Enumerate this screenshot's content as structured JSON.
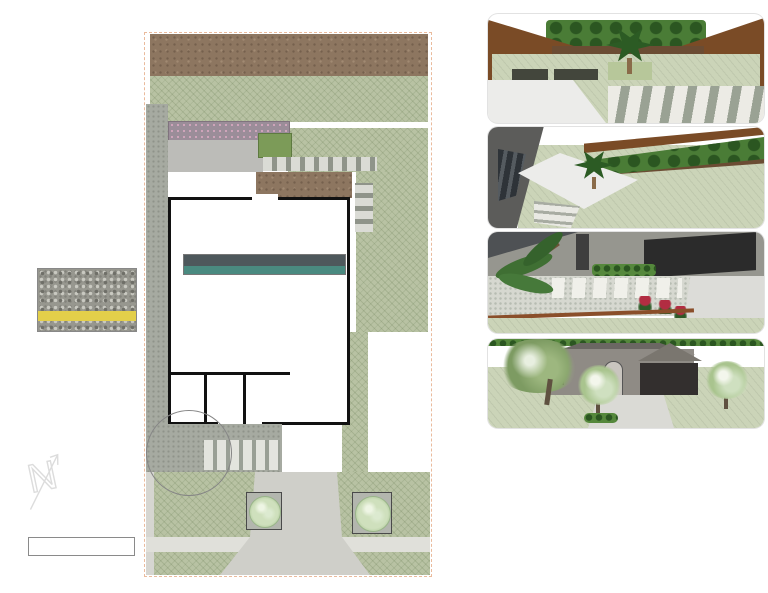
{
  "callouts": [
    {
      "id": "cherry-laurel",
      "text": "Cherry Laurel"
    },
    {
      "id": "tx-mountain-laurel",
      "text": "Tx Mountain Laurel"
    },
    {
      "id": "sago-palm",
      "text": "Sago Palm"
    },
    {
      "id": "saw-palmetto",
      "text": "Saw Palmetto"
    },
    {
      "id": "silvermist-top",
      "text": "5/8\" SILVERMIST\nGRAVEL W. BLACK\nSTEEL EDGING"
    },
    {
      "id": "brakelights-red-yucca",
      "text": "Brakelights Red Yucca"
    },
    {
      "id": "may-night-sage",
      "text": "May Night Sage"
    },
    {
      "id": "pindo-palm",
      "text": "Pindo Palm"
    },
    {
      "id": "autumn-sage-red",
      "text": "Autumn Sage Red"
    },
    {
      "id": "bamboo-muhly",
      "text": "Bamboo Muhly"
    },
    {
      "id": "clumping-bamboo",
      "text": "Clumping Bamboo, Graceful"
    },
    {
      "id": "silvermist-bottom",
      "text": "5/8\" SILVERMIST\nGRAVEL W. BLACK\nSTEEL EDGING"
    },
    {
      "id": "mexican-feathergrass",
      "text": "Mexican Feathergrass"
    },
    {
      "id": "yucca-rostrata",
      "text": "Yucca Rostrata"
    },
    {
      "id": "whales-tongue-agave",
      "text": "Whales Tongue Agave"
    },
    {
      "id": "silver-ponyfoot",
      "text": "Silver Ponyfoot"
    },
    {
      "id": "palo-verde-tree",
      "text": "Palo Verde Tree"
    },
    {
      "id": "crape-myrtle-natchez",
      "text": "Crape Myrtle,\nNatchez"
    }
  ],
  "notes": {
    "steel_edging": "-66 LINEAR FEET\nSTEEL EDGING\n-800 SQ FT MULCH\nAND NEW SOIL",
    "blackstar": "920 SQ FT\n5/8\" BLACKSTAR\nGRAVEL",
    "pavers": "140 SQ FT CUSTOM\nPOURED CONCRETE\nPAVERS, BROOM FINISH",
    "edging_bottom": "110 LINEAR FEET STEEL EDGING"
  },
  "dimensions": {
    "backyard_bed_depth": "12'-6\"",
    "front_gravel_depth": "16'",
    "left_tree_well_width": "7'",
    "right_tree_well_width": "8'",
    "right_tree_well_depth": "10'"
  },
  "graphic_scale": {
    "title": "GRAPHIC SCALE",
    "subtitle": "1\" = 20' on std 8\" x 11\"",
    "segments": [
      "10'",
      "20'",
      "30'"
    ]
  },
  "gravel_swatch": {
    "ruler_numbers": [
      "2",
      "3",
      "4",
      "5",
      "6",
      "7",
      "8"
    ]
  },
  "north": {
    "letter": "N"
  },
  "legend": {
    "title": "Plant Legend",
    "columns": [
      "SYM",
      "QTY",
      "PLANT NAME",
      "SIZE"
    ],
    "left_rows": [
      {
        "qty": "10",
        "name": "Autumn Sage Red",
        "size": "1 gal",
        "color": "#e7b6c1"
      },
      {
        "qty": "10",
        "name": "Bamboo Muhly",
        "size": "5 gal",
        "color": "#72a85e"
      },
      {
        "qty": "12",
        "name": "Brakelights Red Yucca",
        "size": "1 gal",
        "color": "#f0dde2"
      },
      {
        "qty": "10",
        "name": "Cherry Laurel",
        "size": "15 gal",
        "color": "#4e7d43"
      },
      {
        "qty": "8",
        "name": "Clumping Bamboo, Graceful",
        "size": "5 gal",
        "color": "#a9cf97"
      },
      {
        "qty": "2",
        "name": "Crape Myrtle, White Natchez",
        "size": "15 gal",
        "color": "#cfe0c4"
      },
      {
        "qty": "1",
        "name": "Existing",
        "size": "",
        "color": "#ffffff"
      },
      {
        "qty": "10",
        "name": "May Night Sage",
        "size": "1 gal",
        "color": "#c6a3d1"
      }
    ],
    "right_rows": [
      {
        "qty": "44",
        "name": "Mexican Feathergrass",
        "size": "1 gal",
        "color": "#d3c48b"
      },
      {
        "qty": "1",
        "name": "Pindo Palm",
        "size": "15 gal",
        "color": "#4e7d43"
      },
      {
        "qty": "4",
        "name": "Sago Palm",
        "size": "15 gal",
        "color": "#3c6a38"
      },
      {
        "qty": "1",
        "name": "Saw Palmetto",
        "size": "5 gal",
        "color": "#e9ebd9"
      },
      {
        "qty": "11",
        "name": "Silver Ponyfoot",
        "size": "1 gal",
        "color": "#bfe2d5"
      },
      {
        "qty": "3",
        "name": "Tx Mountain Laurel",
        "size": "30 gal",
        "color": "#d8d3ea"
      },
      {
        "qty": "6",
        "name": "Whales Tongue Agave",
        "size": "15 gal",
        "color": "#cfe0d6"
      },
      {
        "qty": "1",
        "name": "Yucca Rostrata",
        "size": "HT: 3-4'",
        "color": "#6b8a6b"
      }
    ]
  },
  "photos": {
    "row1": [
      {
        "label": "AUTUMN SAGE, RED",
        "c1": "#c41f30",
        "c2": "#3f6b33"
      },
      {
        "label": "BAMBOO MUHLY",
        "c1": "#cfe09a",
        "c2": "#7fa45c"
      },
      {
        "label": "Crape Myrtle\nNatchez",
        "c1": "#eeeadb",
        "c2": "#5d7a4a"
      },
      {
        "label": "BRAKELIGHTS RED\nYUCCA",
        "c1": "#b5354d",
        "c2": "#7d8a74"
      },
      {
        "label": "CHERRY LAUREL",
        "c1": "#3f6e30",
        "c2": "#9aa89a"
      },
      {
        "label": "MAY NIGHT SAGE",
        "c1": "#6a5bb0",
        "c2": "#44633c"
      },
      {
        "label": "MEXICAN FEATHER\nGRASS",
        "c1": "#c7c488",
        "c2": "#8a8d55"
      }
    ],
    "row2": [
      {
        "label": "PINDO PALM",
        "c1": "#55703f",
        "c2": "#85add0"
      },
      {
        "label": "SAGO PALM",
        "c1": "#2c5522",
        "c2": "#55913c"
      },
      {
        "label": "SAW PALMETTO",
        "c1": "#7fb35c",
        "c2": "#3f7a31"
      },
      {
        "label": "SILVER PONYFOOT",
        "c1": "#c3d2c6",
        "c2": "#85988a"
      },
      {
        "label": "TX MT LAUREL",
        "c1": "#8f7fd0",
        "c2": "#53714a"
      },
      {
        "label": "WHALES TONGUE\nAGAVE",
        "c1": "#c2cdc5",
        "c2": "#5d4a3a"
      },
      {
        "label": "YUCCA ROSTRATA",
        "c1": "#b8a98c",
        "c2": "#96a874"
      }
    ]
  },
  "colors": {
    "leader": "#1a1a1a",
    "property_line": "#d67a3e",
    "legend_header": "#4e585c",
    "legend_subheader": "#4a8a80"
  }
}
